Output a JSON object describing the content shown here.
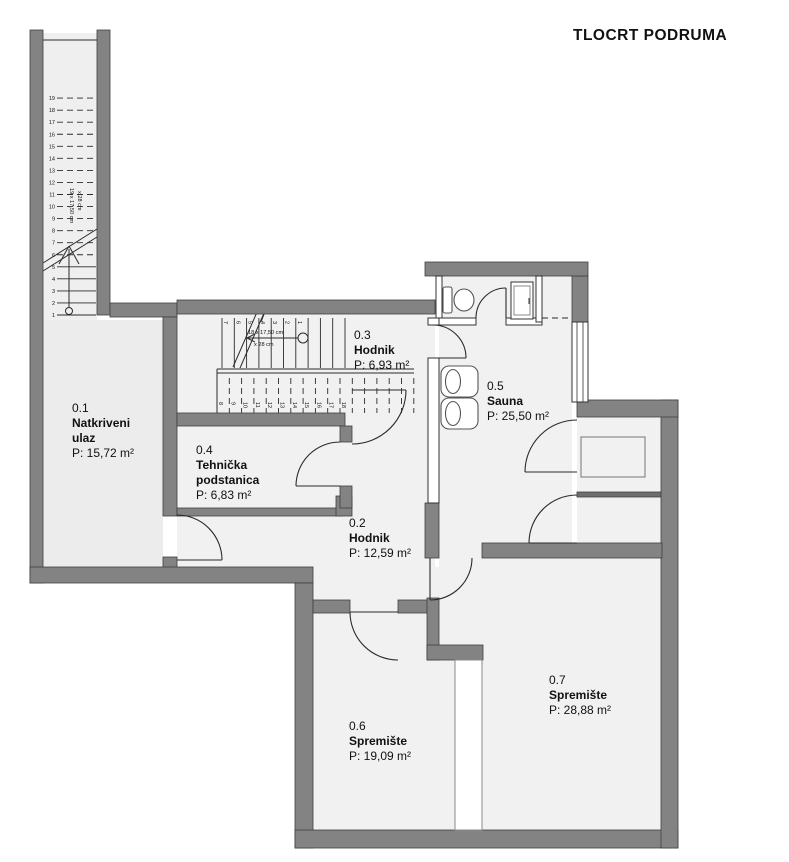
{
  "title": "TLOCRT PODRUMA",
  "rooms": [
    {
      "id": "0.1",
      "name": "Natkriveni ulaz",
      "area": "P: 15,72 m²"
    },
    {
      "id": "0.2",
      "name": "Hodnik",
      "area": "P: 12,59 m²"
    },
    {
      "id": "0.3",
      "name": "Hodnik",
      "area": "P: 6,93 m²"
    },
    {
      "id": "0.4",
      "name": "Tehnička podstanica",
      "area": "P: 6,83 m²"
    },
    {
      "id": "0.5",
      "name": "Sauna",
      "area": "P: 25,50 m²"
    },
    {
      "id": "0.6",
      "name": "Spremište",
      "area": "P: 19,09 m²"
    },
    {
      "id": "0.7",
      "name": "Spremište",
      "area": "P: 28,88 m²"
    }
  ],
  "stairs": {
    "entrance": {
      "step_numbers": [
        "1",
        "2",
        "3",
        "4",
        "5",
        "6",
        "7",
        "8",
        "9",
        "10",
        "11",
        "12",
        "13",
        "14",
        "15",
        "16",
        "17",
        "18",
        "19"
      ],
      "riser_note": "19 x 17,50 cm",
      "tread_note": "x 28 cm"
    },
    "internal": {
      "upper_step_numbers": [
        "1",
        "2",
        "3",
        "4",
        "5",
        "6",
        "7"
      ],
      "lower_step_numbers": [
        "8",
        "9",
        "10",
        "11",
        "12",
        "13",
        "14",
        "15",
        "16",
        "17",
        "18"
      ],
      "riser_note": "18 x 17,50 cm",
      "tread_note": "x 28 cm"
    }
  },
  "fixtures": [
    "toilet",
    "shower-cabinet",
    "washbasin",
    "washbasin",
    "cabinet",
    "window"
  ],
  "colors": {
    "wall": "#838383",
    "floor": "#f1f1f1",
    "line": "#2b2b2b"
  }
}
